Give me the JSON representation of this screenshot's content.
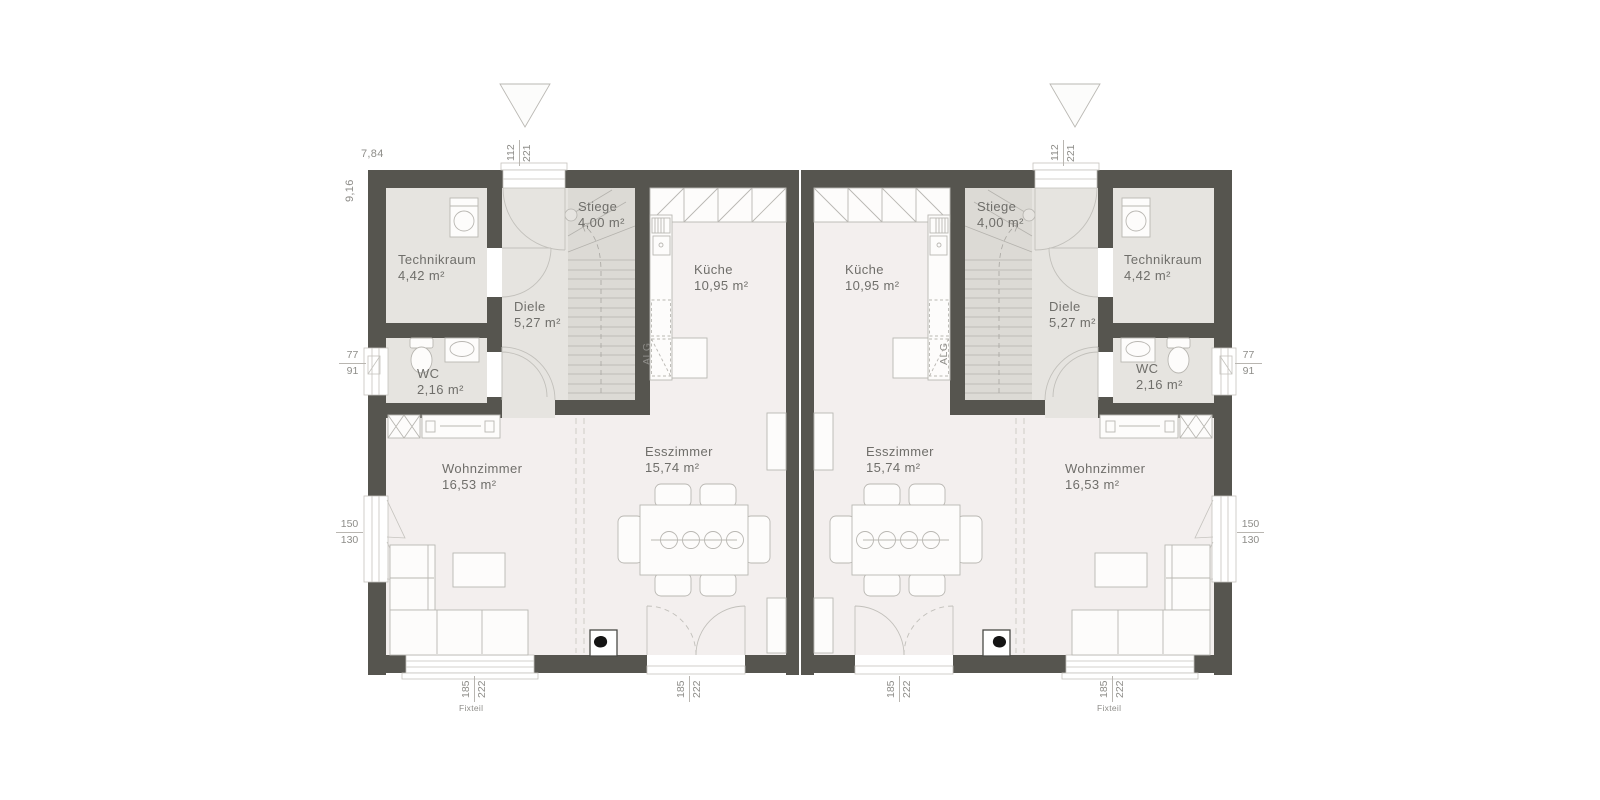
{
  "colors": {
    "wall": "#56554f",
    "floor_main": "#f3efee",
    "floor_service": "#e6e4e0",
    "floor_stair": "#dcdad5",
    "line": "#b9b7b2",
    "dim_text": "#8e8d89",
    "label_text": "#6f6e6a"
  },
  "rooms": {
    "technikraum": {
      "name": "Technikraum",
      "area": "4,42 m²"
    },
    "wc": {
      "name": "WC",
      "area": "2,16 m²"
    },
    "diele": {
      "name": "Diele",
      "area": "5,27 m²"
    },
    "stiege": {
      "name": "Stiege",
      "area": "4,00 m²"
    },
    "kueche": {
      "name": "Küche",
      "area": "10,95 m²"
    },
    "esszimmer": {
      "name": "Esszimmer",
      "area": "15,74 m²"
    },
    "wohnzimmer": {
      "name": "Wohnzimmer",
      "area": "16,53 m²"
    }
  },
  "dimensions": {
    "unit_width": "7,84",
    "unit_depth": "9,16",
    "entrance_door": {
      "width": "112",
      "height": "221"
    },
    "wc_window": {
      "width": "77",
      "height": "91"
    },
    "living_window": {
      "width": "150",
      "height": "130"
    },
    "terrace_door": {
      "width": "185",
      "height": "222"
    },
    "fixed_window": {
      "width": "185",
      "height": "222"
    },
    "fixed_window_note": "Fixteil"
  },
  "annotations": {
    "kitchen_counter": "ALG"
  }
}
